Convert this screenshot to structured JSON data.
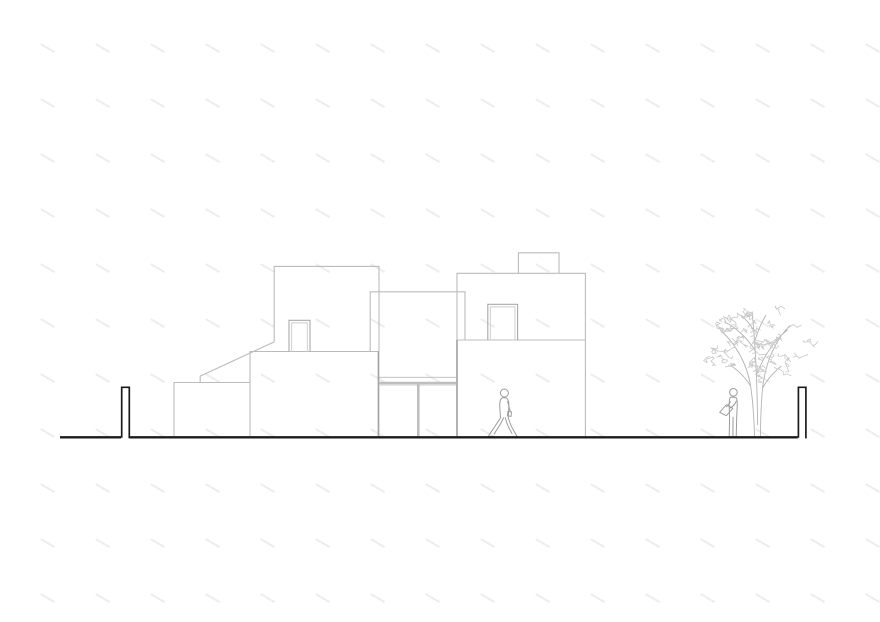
{
  "document": {
    "type": "architectural-elevation-line-drawing",
    "visible_text": "",
    "background": "#ffffff"
  },
  "colors": {
    "tick": "#ededed",
    "outline_light": "#bcbcbc",
    "outline_medium": "#a4a4a4",
    "door_outer": "#a9a9a9",
    "door_inner": "#d4d4d4",
    "glass_frame": "#bfbfbf",
    "glass_frame_light": "#e2e2e2",
    "figure": "#9c9c9c",
    "branch": "#b3b3b3",
    "foliage": "#c9c9c9",
    "ink": "#1b1b1b"
  },
  "pattern": {
    "tick_start_x": 47,
    "tick_start_y": 48,
    "tick_step_x": 55,
    "tick_step_y": 55,
    "tick_cols": 16,
    "tick_rows": 11
  },
  "scene": {
    "elements": [
      "background-tick-pattern",
      "volume-upper-left",
      "volume-middle-upper",
      "volume-lower-left",
      "volume-lower-middle",
      "volume-right-upper",
      "volume-right-lower",
      "roof-box",
      "entry-door-left",
      "entry-door-right",
      "glass-recess",
      "ramp-roof-line",
      "ground-line",
      "boundary-post-left",
      "boundary-post-right",
      "walking-person",
      "standing-person-reading",
      "tree"
    ]
  }
}
